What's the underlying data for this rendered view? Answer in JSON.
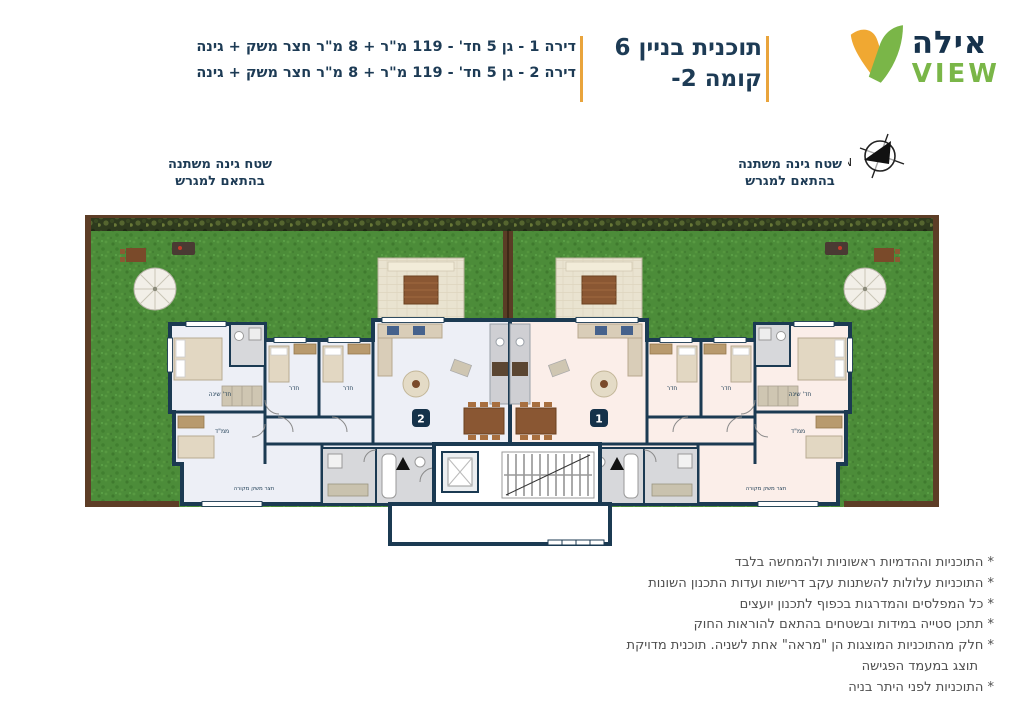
{
  "header": {
    "brand": {
      "name_hebrew": "אילה",
      "name_latin": "VIEW"
    },
    "title": {
      "line1": "תוכנית בניין 6",
      "line2": "קומה 2-"
    },
    "apartment_specs": {
      "line1": "דירה 1 - גן 5 חד' - 119 מ\"ר + 8 מ\"ר חצר משק + גינה",
      "line2": "דירה 2 - גן 5 חד' - 119 מ\"ר + 8 מ\"ר חצר משק + גינה"
    }
  },
  "plan": {
    "compass_label": "N",
    "garden_note": {
      "line1": "שטח גינה משתנה",
      "line2": "בהתאם למגרש"
    },
    "badges": {
      "left_unit": "2",
      "right_unit": "1"
    },
    "room_labels": {
      "master": "חד' שינה",
      "bedroom": "חדר",
      "mamad": "ממ\"ד",
      "utility": "חצר משק מקורה"
    },
    "colors": {
      "wall": "#1b3a52",
      "floor_unit2": "#edeff6",
      "floor_unit1": "#fbeee9",
      "grass": "#4c8c39",
      "accent_orange": "#e9a43c",
      "logo_green": "#7ab648",
      "logo_yellow": "#f0a832"
    }
  },
  "disclaimer": {
    "lines": [
      "* התוכניות וההדמיות ראשוניות ולהמחשה בלבד",
      "* התוכניות עלולות להשתנות עקב דרישות ועדות התכנון השונות",
      "* כל המפלסים והמדרגות בכפוף לתכנון יועצים",
      "* תתכן סטייה במידות ובשטחים בהתאם להוראות החוק",
      "* חלק מהתוכניות המוצגות הן \"מראה\" אחת לשניה. תוכנית מדויקת",
      "תוצג במעמד הפגישה",
      "* התוכניות לפני היתר בניה"
    ]
  }
}
